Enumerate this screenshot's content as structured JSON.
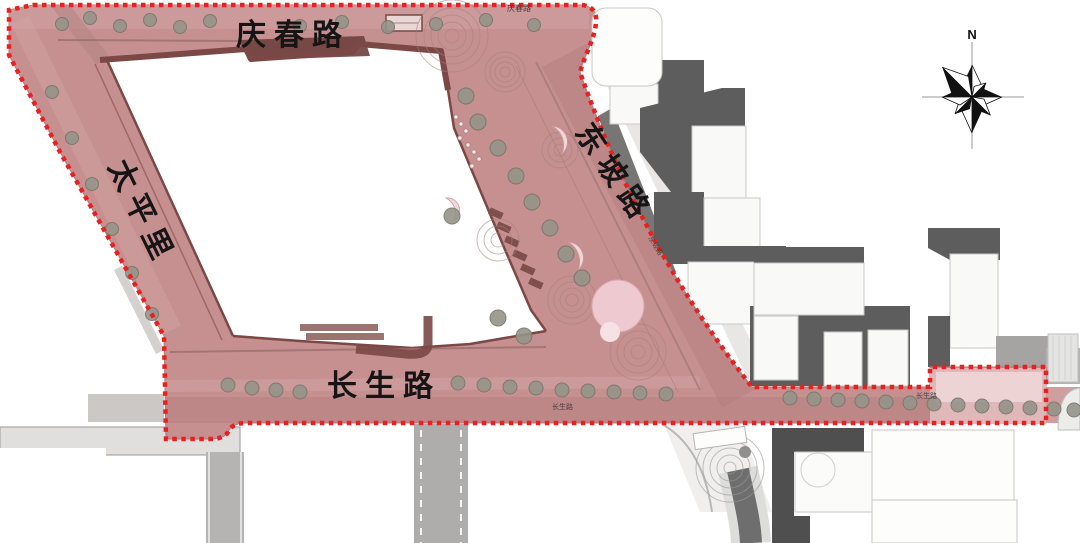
{
  "labels": {
    "qingchun_road": "庆春路",
    "taipingli": "太平里",
    "dongpo_road": "东坡路",
    "changsheng_road": "长生路",
    "qingchun_small": "庆春路",
    "dongpo_small": "东坡路",
    "changsheng_small_west": "长生路",
    "changsheng_small_east": "长生路"
  },
  "compass": {
    "north_label": "N"
  },
  "colors": {
    "boundary_red": "#e8201f",
    "road_pink": "#c69090",
    "road_pink_dark": "#b27c7c",
    "road_pink_light": "#d4a6a6",
    "plaza_light_pink": "#e0b8ba",
    "plaza_highlight_pink": "#eed3d5",
    "curb_maroon": "#7b4845",
    "building_face": "#f9f9f7",
    "building_shadow": "#5d5d5d",
    "road_gray": "#b3b2b0",
    "tree_gray": "#95948a",
    "block_white": "#ffffff"
  }
}
